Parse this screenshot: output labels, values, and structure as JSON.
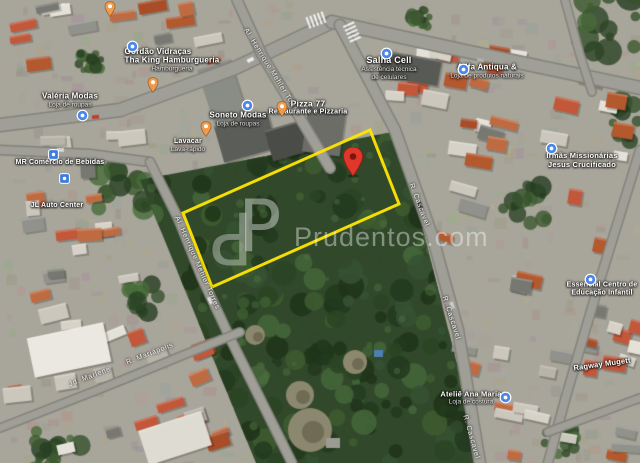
{
  "map": {
    "view_type": "satellite",
    "highlight": {
      "color": "#ffe600",
      "points": [
        [
          183,
          213
        ],
        [
          370,
          130
        ],
        [
          399,
          204
        ],
        [
          212,
          287
        ]
      ]
    },
    "marker_colors": {
      "red": "#e1372b",
      "orange": "#f09a4b",
      "blue": "#4b86e8",
      "blue_square": "#3f7ce0"
    },
    "markers": [
      {
        "name": "red-location-pin",
        "type": "red-pin",
        "x": 353,
        "y": 176
      },
      {
        "name": "poi-pin-north",
        "type": "orange-pin",
        "x": 110,
        "y": 6
      },
      {
        "name": "poi-pin-west",
        "type": "orange-pin",
        "x": 153,
        "y": 82
      },
      {
        "name": "lavacar-pin",
        "type": "orange-pin",
        "x": 206,
        "y": 126
      },
      {
        "name": "pizza-77-pin",
        "type": "orange-pin",
        "x": 282,
        "y": 106
      },
      {
        "name": "gordao-vidracas-pin",
        "type": "blue-poi",
        "x": 132,
        "y": 46
      },
      {
        "name": "valeria-modas-pin",
        "type": "blue-poi",
        "x": 82,
        "y": 115
      },
      {
        "name": "soneto-modas-pin",
        "type": "blue-poi",
        "x": 247,
        "y": 105
      },
      {
        "name": "salha-cell-pin",
        "type": "blue-poi",
        "x": 386,
        "y": 53
      },
      {
        "name": "allfa-pin",
        "type": "blue-poi",
        "x": 463,
        "y": 69
      },
      {
        "name": "irmas-missionarias-pin",
        "type": "blue-poi",
        "x": 551,
        "y": 148
      },
      {
        "name": "essencial-pin",
        "type": "blue-poi",
        "x": 590,
        "y": 279
      },
      {
        "name": "atelie-ana-maria-pin",
        "type": "blue-poi",
        "x": 505,
        "y": 397
      },
      {
        "name": "mr-bebidas-pin",
        "type": "blue-square",
        "x": 53,
        "y": 152
      },
      {
        "name": "jl-auto-center-pin",
        "type": "blue-square",
        "x": 64,
        "y": 176
      }
    ],
    "poi_labels": [
      {
        "name": "gordao-vidracas",
        "x": 158,
        "y": 52,
        "lines": [
          {
            "text": "Gordão Vidraças",
            "size": 8,
            "cls": "primary"
          }
        ]
      },
      {
        "name": "tha-king",
        "x": 172,
        "y": 64,
        "lines": [
          {
            "text": "Tha King Hamburgueria",
            "size": 8,
            "cls": "primary"
          },
          {
            "text": "Hamburgueria",
            "size": 6.5,
            "cls": "secondary"
          }
        ]
      },
      {
        "name": "valeria-modas",
        "x": 70,
        "y": 100,
        "lines": [
          {
            "text": "Valéria Modas",
            "size": 8,
            "cls": "primary"
          },
          {
            "text": "Loja de roupas",
            "size": 6.5,
            "cls": "secondary"
          }
        ]
      },
      {
        "name": "mr-comercio-bebidas",
        "x": 60,
        "y": 163,
        "lines": [
          {
            "text": "MR Comércio de Bebidas",
            "size": 7,
            "cls": "primary"
          }
        ]
      },
      {
        "name": "jl-auto-center",
        "x": 57,
        "y": 206,
        "lines": [
          {
            "text": "JL Auto Center",
            "size": 7,
            "cls": "primary"
          }
        ]
      },
      {
        "name": "soneto-modas",
        "x": 238,
        "y": 119,
        "lines": [
          {
            "text": "Soneto Modas",
            "size": 8,
            "cls": "primary"
          },
          {
            "text": "Loja de roupas",
            "size": 6.5,
            "cls": "secondary"
          }
        ]
      },
      {
        "name": "lavacar",
        "x": 188,
        "y": 146,
        "lines": [
          {
            "text": "Lavacar",
            "size": 7,
            "cls": "primary"
          },
          {
            "text": "Lava-rápido",
            "size": 6.5,
            "cls": "secondary"
          }
        ]
      },
      {
        "name": "pizza-77",
        "x": 308,
        "y": 108,
        "lines": [
          {
            "text": "Pizza 77",
            "size": 8.5,
            "cls": "primary"
          },
          {
            "text": "Restaurante e Pizzaria",
            "size": 7,
            "cls": "primary"
          }
        ]
      },
      {
        "name": "salha-cell",
        "x": 389,
        "y": 68,
        "lines": [
          {
            "text": "Salha Cell",
            "size": 9,
            "cls": "primary"
          },
          {
            "text": "Assistência técnica",
            "size": 6.5,
            "cls": "secondary"
          },
          {
            "text": "de celulares",
            "size": 6.5,
            "cls": "secondary"
          }
        ]
      },
      {
        "name": "allfa",
        "x": 487,
        "y": 71,
        "lines": [
          {
            "text": "Allfa Antiqua &",
            "size": 8,
            "cls": "primary"
          },
          {
            "text": "Loja de produtos naturais",
            "size": 6.5,
            "cls": "secondary"
          }
        ]
      },
      {
        "name": "irmas-missionarias",
        "x": 582,
        "y": 160,
        "lines": [
          {
            "text": "Irmãs Missionárias",
            "size": 7.5,
            "cls": "primary"
          },
          {
            "text": "Jesus Crucificado",
            "size": 7.5,
            "cls": "primary"
          }
        ]
      },
      {
        "name": "essencial-educacao",
        "x": 602,
        "y": 290,
        "lines": [
          {
            "text": "Essencial Centro de",
            "size": 7,
            "cls": "primary"
          },
          {
            "text": "Educação Infantil",
            "size": 7,
            "cls": "primary"
          }
        ]
      },
      {
        "name": "atelie-ana-maria",
        "x": 471,
        "y": 398,
        "lines": [
          {
            "text": "Ateliê Ana Maria",
            "size": 7.5,
            "cls": "primary"
          },
          {
            "text": "Loja de costura",
            "size": 6.5,
            "cls": "secondary"
          }
        ]
      },
      {
        "name": "ragway-mugett",
        "x": 602,
        "y": 364,
        "rot": -8,
        "lines": [
          {
            "text": "Ragway Mugett",
            "size": 7.5,
            "cls": "primary"
          }
        ]
      }
    ],
    "street_labels": [
      {
        "name": "street-henrique-mehler-north",
        "x": 272,
        "y": 72,
        "rot": 58,
        "text": "Al. Henrique Mehler Torres"
      },
      {
        "name": "street-henrique-mehler-south",
        "x": 197,
        "y": 263,
        "rot": 66,
        "text": "Al. Henrique Mehler Torres"
      },
      {
        "name": "street-cascavel-1",
        "x": 419,
        "y": 205,
        "rot": 69,
        "text": "R. Cascavel"
      },
      {
        "name": "street-cascavel-2",
        "x": 451,
        "y": 318,
        "rot": 72,
        "text": "R. Cascavel"
      },
      {
        "name": "street-cascavel-3",
        "x": 471,
        "y": 437,
        "rot": 74,
        "text": "R. Cascavel"
      },
      {
        "name": "street-marlene",
        "x": 90,
        "y": 377,
        "rot": -21,
        "text": "Jd. Marlene"
      },
      {
        "name": "street-mariapolis",
        "x": 150,
        "y": 354,
        "rot": -21,
        "text": "R. Mariápolis"
      }
    ]
  },
  "watermark": {
    "logo_text": "P",
    "text": "Prudentos.com"
  }
}
